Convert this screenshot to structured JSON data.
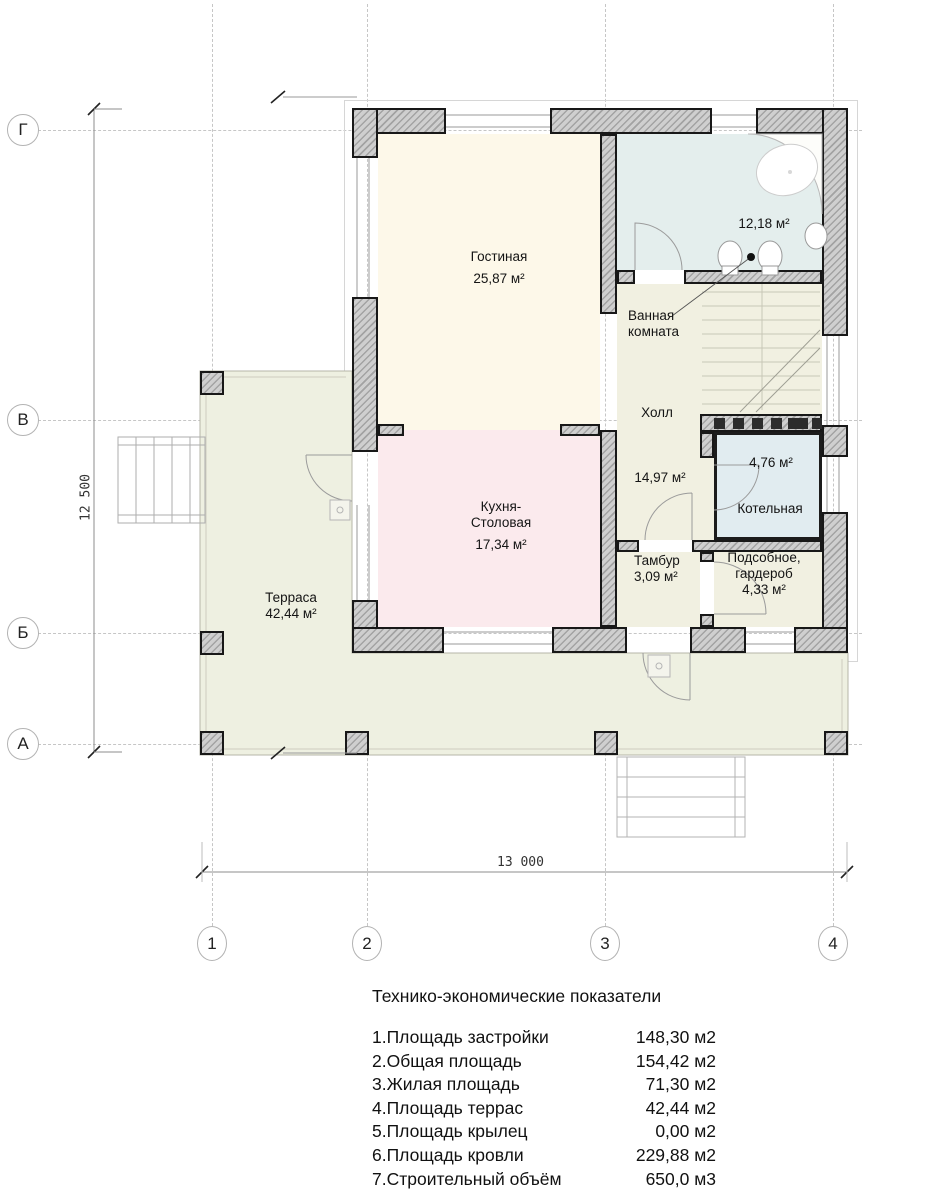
{
  "axes": {
    "rows": [
      "Г",
      "В",
      "Б",
      "А"
    ],
    "cols": [
      "1",
      "2",
      "3",
      "4"
    ]
  },
  "dimensions": {
    "left": "12 500",
    "bottom": "13 000"
  },
  "rooms": {
    "living": {
      "name": "Гостиная",
      "area": "25,87 м²"
    },
    "bathroom": {
      "name_line1": "Ванная",
      "name_line2": "комната",
      "area": "12,18 м²"
    },
    "hall": {
      "name": "Холл",
      "area": "14,97 м²"
    },
    "kitchen": {
      "name_line1": "Кухня-",
      "name_line2": "Столовая",
      "area": "17,34 м²"
    },
    "tambur": {
      "name": "Тамбур",
      "area": "3,09 м²"
    },
    "boiler": {
      "name": "Котельная",
      "area": "4,76 м²"
    },
    "utility": {
      "name_line1": "Подсобное,",
      "name_line2": "гардероб",
      "area": "4,33 м²"
    },
    "terrace": {
      "name": "Терраса",
      "area": "42,44 м²"
    }
  },
  "palette": {
    "living_fill": "#fdf8e9",
    "kitchen_fill": "#fbeaed",
    "bathroom_fill": "#e4eeed",
    "hall_fill": "#f1f0e1",
    "boiler_fill": "#e1ecf0",
    "terrace_fill": "#eef0e1",
    "wall_fill": "#cfcfcf"
  },
  "table": {
    "title": "Технико-экономические показатели",
    "rows": [
      {
        "label": "1.Площадь застройки",
        "value": "148,30 м2"
      },
      {
        "label": "2.Общая площадь",
        "value": "154,42 м2"
      },
      {
        "label": "3.Жилая площадь",
        "value": "71,30 м2"
      },
      {
        "label": "4.Площадь террас",
        "value": "42,44 м2"
      },
      {
        "label": "5.Площадь крылец",
        "value": "0,00 м2"
      },
      {
        "label": "6.Площадь кровли",
        "value": "229,88 м2"
      },
      {
        "label": "7.Строительный объём",
        "value": "650,0 м3"
      }
    ]
  }
}
